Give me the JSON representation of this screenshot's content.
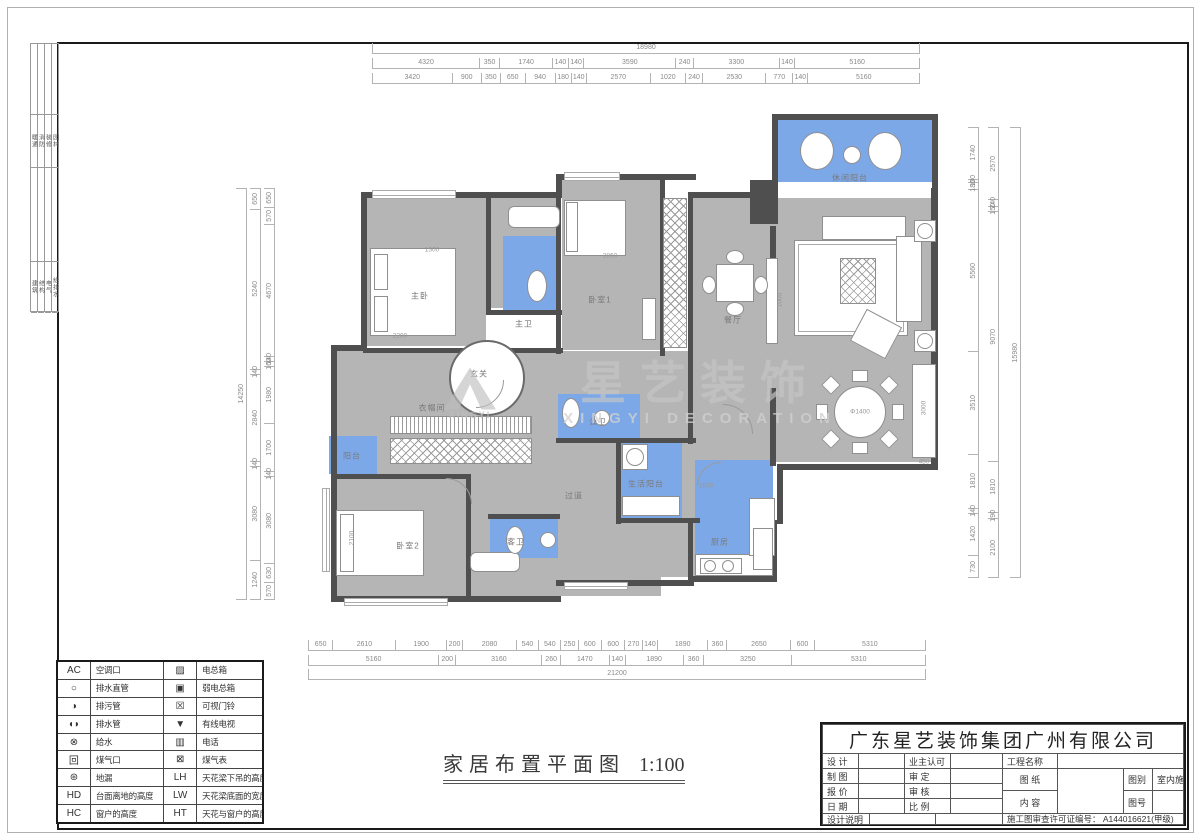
{
  "sheet": {
    "strip_top": [
      "暖通",
      "消防",
      "装修",
      "园林"
    ],
    "strip_bottom": [
      "建筑",
      "结构",
      "电气",
      "给排水"
    ]
  },
  "dims": {
    "top_total": [
      "18980"
    ],
    "top_row2": [
      "4320",
      "350",
      "1740",
      "140",
      "140",
      "3590",
      "240",
      "3300",
      "140",
      "5160"
    ],
    "top_row3": [
      "3420",
      "900",
      "350",
      "650",
      "940",
      "180",
      "140",
      "2570",
      "1020",
      "240",
      "2530",
      "770",
      "140",
      "5160"
    ],
    "bottom_row1": [
      "650",
      "2610",
      "1900",
      "200",
      "2080",
      "540",
      "540",
      "250",
      "600",
      "600",
      "270",
      "140",
      "1890",
      "360",
      "2650",
      "600",
      "5310"
    ],
    "bottom_row2": [
      "5160",
      "200",
      "3160",
      "260",
      "1470",
      "140",
      "1890",
      "360",
      "3250",
      "5310"
    ],
    "bottom_total": [
      "21200"
    ],
    "left_outer": [
      "14250"
    ],
    "left_mid": [
      "650",
      "5240",
      "140",
      "2840",
      "140",
      "3080",
      "1240"
    ],
    "left_inner": [
      "650",
      "570",
      "4670",
      "140",
      "160",
      "1980",
      "1700",
      "140",
      "3080",
      "630",
      "570"
    ],
    "right_inner": [
      "1740",
      "100",
      "180",
      "5560",
      "3510",
      "1810",
      "140",
      "1420",
      "730"
    ],
    "right_mid": [
      "2570",
      "240",
      "150",
      "9070",
      "1810",
      "190",
      "2100"
    ],
    "right_outer": [
      "15980"
    ]
  },
  "plan": {
    "title": "家居布置平面图",
    "scale": "1:100",
    "rooms": [
      {
        "label": "休闲阳台",
        "x": 850,
        "y": 178
      },
      {
        "label": "主卧",
        "x": 420,
        "y": 296
      },
      {
        "label": "主卫",
        "x": 524,
        "y": 324
      },
      {
        "label": "玄关",
        "x": 479,
        "y": 374
      },
      {
        "label": "衣帽间",
        "x": 432,
        "y": 408
      },
      {
        "label": "卧室1",
        "x": 600,
        "y": 300
      },
      {
        "label": "餐厅",
        "x": 733,
        "y": 320
      },
      {
        "label": "过道",
        "x": 574,
        "y": 496
      },
      {
        "label": "公卫",
        "x": 598,
        "y": 422
      },
      {
        "label": "生活阳台",
        "x": 646,
        "y": 484
      },
      {
        "label": "厨房",
        "x": 720,
        "y": 542
      },
      {
        "label": "阳台",
        "x": 352,
        "y": 456
      },
      {
        "label": "卧室2",
        "x": 408,
        "y": 546
      },
      {
        "label": "客卫",
        "x": 516,
        "y": 542
      }
    ],
    "annotations": [
      {
        "text": "2200",
        "x": 400,
        "y": 336,
        "rot": 0
      },
      {
        "text": "1500",
        "x": 432,
        "y": 250,
        "rot": 0
      },
      {
        "text": "Φ1400",
        "x": 860,
        "y": 412,
        "rot": 0
      },
      {
        "text": "3000",
        "x": 924,
        "y": 408,
        "rot": 1
      },
      {
        "text": "450",
        "x": 924,
        "y": 462,
        "rot": 0
      },
      {
        "text": "1000",
        "x": 780,
        "y": 300,
        "rot": 1
      },
      {
        "text": "1530",
        "x": 706,
        "y": 486,
        "rot": 0
      },
      {
        "text": "2100",
        "x": 352,
        "y": 538,
        "rot": 1
      },
      {
        "text": "2860",
        "x": 610,
        "y": 256,
        "rot": 0
      }
    ]
  },
  "watermark": {
    "logo": "XINGYI",
    "title": "星艺装饰",
    "subtitle": "XINGYI DECORATION"
  },
  "legend": {
    "rows": [
      {
        "s1": "AC",
        "l1": "空调口",
        "s2": "▨",
        "l2": "电总箱"
      },
      {
        "s1": "○",
        "l1": "排水直管",
        "s2": "▣",
        "l2": "弱电总箱"
      },
      {
        "s1": "◑",
        "l1": "排污管",
        "s2": "☒",
        "l2": "可视门铃"
      },
      {
        "s1": "◖◗",
        "l1": "排水管",
        "s2": "▼",
        "l2": "有线电视"
      },
      {
        "s1": "⊗",
        "l1": "给水",
        "s2": "▥",
        "l2": "电话"
      },
      {
        "s1": "回",
        "l1": "煤气口",
        "s2": "⊠",
        "l2": "煤气表"
      },
      {
        "s1": "⊛",
        "l1": "地漏",
        "s2": "LH",
        "l2": "天花梁下吊的高度"
      },
      {
        "s1": "HD",
        "l1": "台面离地的高度",
        "s2": "LW",
        "l2": "天花梁底面的宽度"
      },
      {
        "s1": "HC",
        "l1": "窗户的高度",
        "s2": "HT",
        "l2": "天花与窗户的高度"
      }
    ]
  },
  "titleblock": {
    "company": "广东星艺装饰集团广州有限公司",
    "f_design": "设 计",
    "f_draft": "制 图",
    "f_quote": "报 价",
    "f_date": "日 期",
    "f_note": "设计说明",
    "f_owner": "业主认可",
    "f_approve": "审 定",
    "f_check": "审 核",
    "f_ratio": "比 例",
    "f_project": "工程名称",
    "f_sheet": "图 纸",
    "f_content": "内 容",
    "f_type_label": "图别",
    "f_type_value": "室内施",
    "f_no_label": "图号",
    "license": "施工图审查许可证编号：  A144016621(甲级)"
  }
}
